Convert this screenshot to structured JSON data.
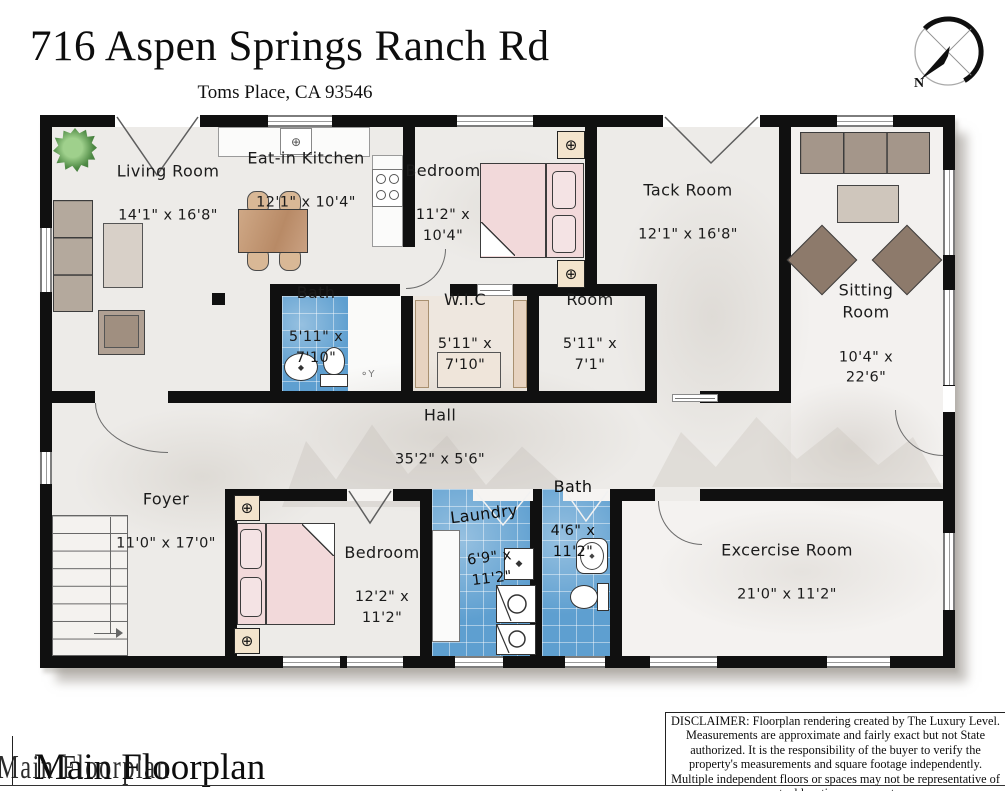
{
  "header": {
    "title": "716 Aspen Springs Ranch Rd",
    "subtitle": "Toms Place, CA 93546",
    "compass_label": "N"
  },
  "rooms": {
    "living": {
      "name": "Living Room",
      "dims": "14'1\" x 16'8\""
    },
    "kitchen": {
      "name": "Eat-in Kitchen",
      "dims": "12'1\" x 10'4\""
    },
    "bedroom_top": {
      "name": "Bedroom",
      "dims": "11'2\" x\n10'4\""
    },
    "tack": {
      "name": "Tack Room",
      "dims": "12'1\" x 16'8\""
    },
    "sitting": {
      "name": "Sitting Room",
      "dims": "10'4\" x 22'6\""
    },
    "bath_mid": {
      "name": "Bath",
      "dims": "5'11\" x\n7'10\""
    },
    "wic": {
      "name": "W.I.C",
      "dims": "5'11\" x\n7'10\""
    },
    "room": {
      "name": "Room",
      "dims": "5'11\" x\n7'1\""
    },
    "hall": {
      "name": "Hall",
      "dims": "35'2\" x 5'6\""
    },
    "foyer": {
      "name": "Foyer",
      "dims": "11'0\" x 17'0\""
    },
    "bedroom_bottom": {
      "name": "Bedroom",
      "dims": "12'2\" x\n11'2\""
    },
    "laundry": {
      "name": "Laundry",
      "dims": "6'9\" x\n11'2\""
    },
    "bath_bottom": {
      "name": "Bath",
      "dims": "4'6\" x\n11'2\""
    },
    "exercise": {
      "name": "Excercise Room",
      "dims": "21'0\" x 11'2\""
    }
  },
  "footer": {
    "plan_label": "Main Floorplan",
    "disclaimer": "DISCLAIMER: Floorplan rendering created by The Luxury Level. Measurements are approximate and fairly exact but not State authorized. It is the responsibility of the buyer to verify the property's measurements and square footage independently. Multiple independent floors or spaces may not be representative of actual location on property."
  },
  "colors": {
    "wall": "#101010",
    "floor": "#edebe8",
    "tile_blue": "#5e9fd0",
    "bed_pink": "#f2d9da",
    "table_tan": "#c49a7d"
  }
}
